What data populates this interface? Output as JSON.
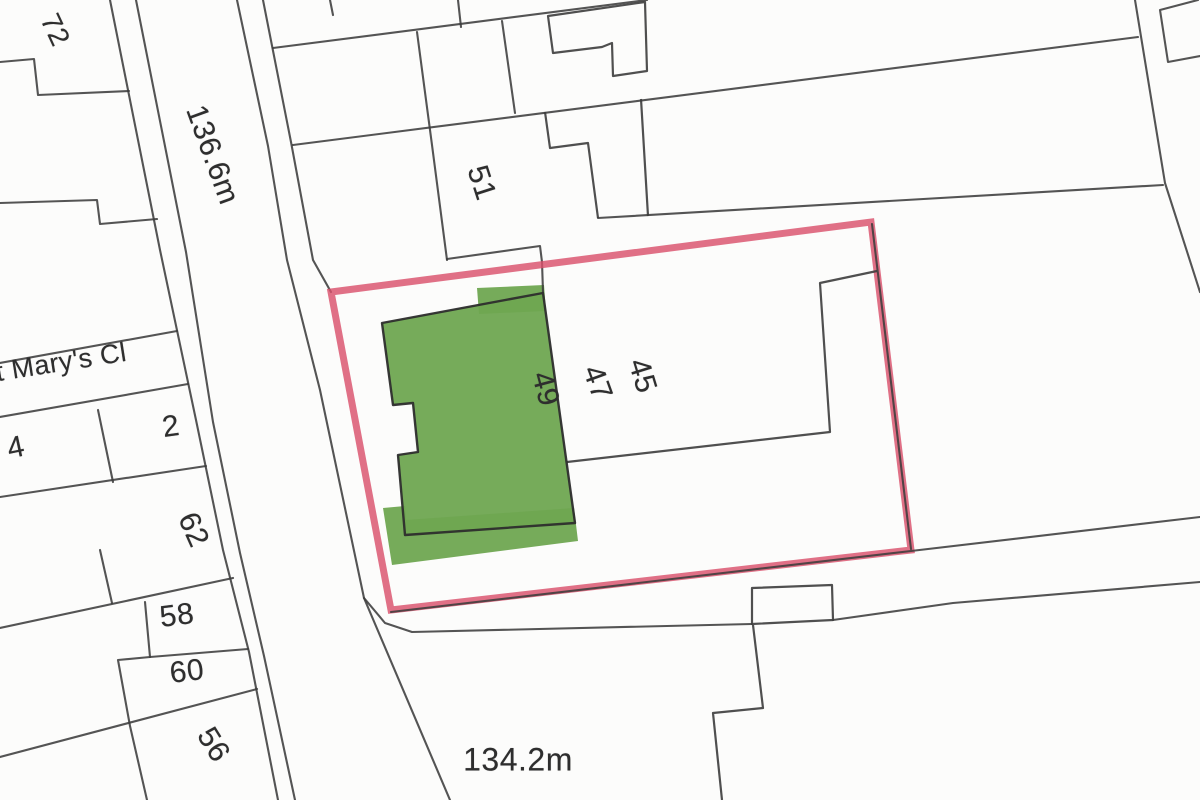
{
  "map": {
    "street_name": "St Mary's Cl",
    "spot_height_north": "136.6m",
    "spot_height_south": "134.2m",
    "house_numbers": {
      "n72": "72",
      "n51": "51",
      "n49": "49",
      "n47": "47",
      "n45": "45",
      "n4": "4",
      "n2": "2",
      "n62": "62",
      "n58": "58",
      "n60": "60",
      "n56": "56"
    },
    "colors": {
      "site_boundary_red": "#d9506b",
      "building_highlight_green": "#6fa751",
      "map_line": "#3c3c3c",
      "paper": "#fcfcfb"
    }
  }
}
